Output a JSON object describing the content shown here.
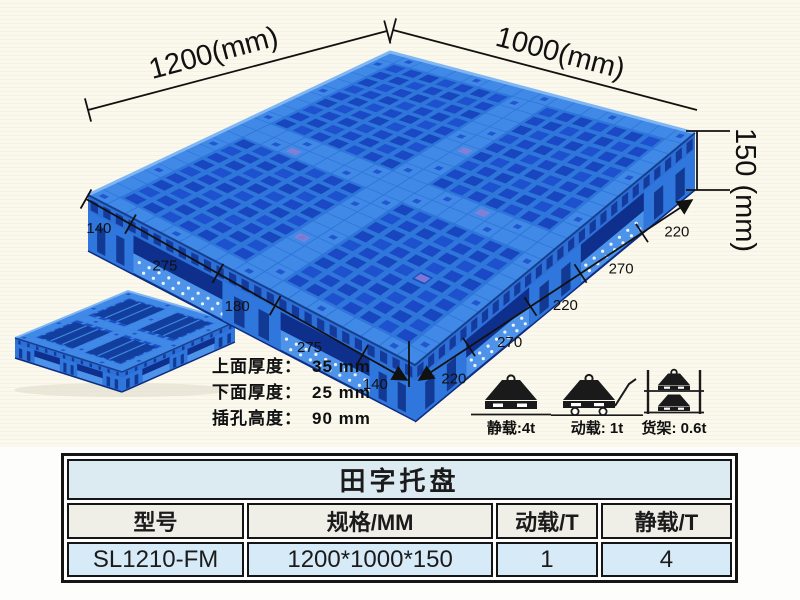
{
  "illustration": {
    "length_label": "1200(mm)",
    "width_label": "1000(mm)",
    "height_label": "150 (mm)",
    "left_chain": [
      "140",
      "275",
      "180",
      "275",
      "140"
    ],
    "right_chain": [
      "220",
      "270",
      "220",
      "270",
      "220"
    ]
  },
  "specs": [
    {
      "label": "上面厚度：",
      "value": "35 mm"
    },
    {
      "label": "下面厚度：",
      "value": "25 mm"
    },
    {
      "label": "插孔高度：",
      "value": "90 mm"
    }
  ],
  "loads": [
    {
      "icon": "static-load-icon",
      "label": "静载:4t"
    },
    {
      "icon": "dynamic-load-icon",
      "label": "动载: 1t"
    },
    {
      "icon": "rack-load-icon",
      "label": "货架: 0.6t"
    }
  ],
  "table": {
    "title": "田字托盘",
    "headers": [
      "型号",
      "规格/MM",
      "动载/T",
      "静载/T"
    ],
    "rows": [
      [
        "SL1210-FM",
        "1200*1000*150",
        "1",
        "4"
      ]
    ]
  },
  "colors": {
    "background": "#faf8ec",
    "line": "#111111",
    "table_title_bg": "#dcebf2",
    "table_header_bg": "#efeee7",
    "table_row_bg": "#d7eaf7",
    "pallet": {
      "base": "#2E76DA",
      "hole_a": "#1B49C6",
      "hole_b": "#1E51CE",
      "hole_c": "#1846BE",
      "runner": "#4189E6",
      "runner_slot": "#1E52CC",
      "rim_light": "#7FB6F3",
      "rim_dark": "#16408F",
      "side_deck": "#2C6FD6",
      "side_slot": "#143A9C",
      "side_dark": "#123B93",
      "foot": "#2F77DC",
      "foot_slot": "#123A95",
      "fork_shadow": "#0E2F8C",
      "inner_deck": "#4E93EA",
      "dot": "#ffffff",
      "patch": "#8C7FD6",
      "bottom_edge": "#0D2B80",
      "small_base": "#3C86E2",
      "small_hole": "#1D50C8",
      "small_window": "#123E9E"
    }
  }
}
